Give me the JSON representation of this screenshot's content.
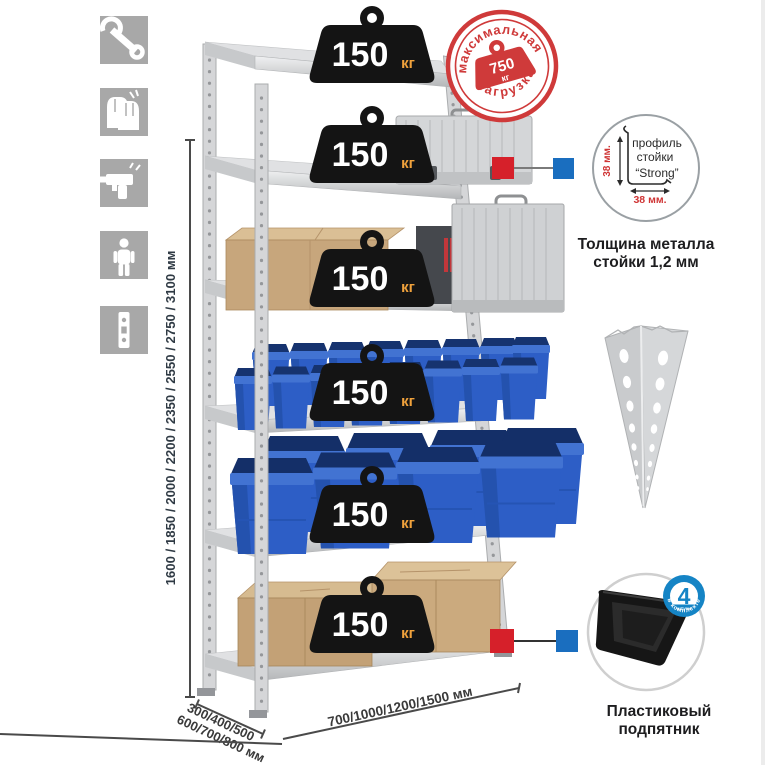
{
  "colors": {
    "accent_red": "#cf3a3a",
    "marker_red": "#d6202a",
    "marker_blue": "#1a6ebf",
    "badge_blue": "#1584c5",
    "bin_blue": "#2d5ec6",
    "icon_gray": "#a8a8a8",
    "weight_black": "#141414",
    "weight_unit_orange": "#f0a23c",
    "cardboard": "#c7a67c",
    "metal_light": "#d5d6d8"
  },
  "left_icons": [
    {
      "name": "wrench-icon"
    },
    {
      "name": "gloves-icon"
    },
    {
      "name": "drill-icon"
    },
    {
      "name": "person-icon"
    },
    {
      "name": "perforated-post-icon"
    }
  ],
  "max_load_stamp": {
    "arc_top": "максимальная",
    "arc_bottom": "нагрузка",
    "value": "750",
    "unit": "кг"
  },
  "shelf_loads": [
    {
      "value": "150",
      "unit": "кг"
    },
    {
      "value": "150",
      "unit": "кг"
    },
    {
      "value": "150",
      "unit": "кг"
    },
    {
      "value": "150",
      "unit": "кг"
    },
    {
      "value": "150",
      "unit": "кг"
    },
    {
      "value": "150",
      "unit": "кг"
    }
  ],
  "dimensions": {
    "height_options": "1600 / 1850 / 2000 / 2200 / 2350 / 2550 / 2750 / 3100 мм",
    "depth_options_line1": "300/400/500",
    "depth_options_line2": "600/700/800 мм",
    "width_options": "700/1000/1200/1500 мм"
  },
  "profile_detail": {
    "label_line1": "профиль",
    "label_line2": "стойки",
    "label_line3": "“Strong”",
    "dim_vertical": "38 мм.",
    "dim_horizontal": "38 мм.",
    "caption_line1": "Толщина металла",
    "caption_line2": "стойки 1,2 мм"
  },
  "foot_detail": {
    "badge_value": "4",
    "badge_small_text": "штуки",
    "badge_arc_text": "в комплекте",
    "caption_line1": "Пластиковый",
    "caption_line2": "подпятник"
  }
}
